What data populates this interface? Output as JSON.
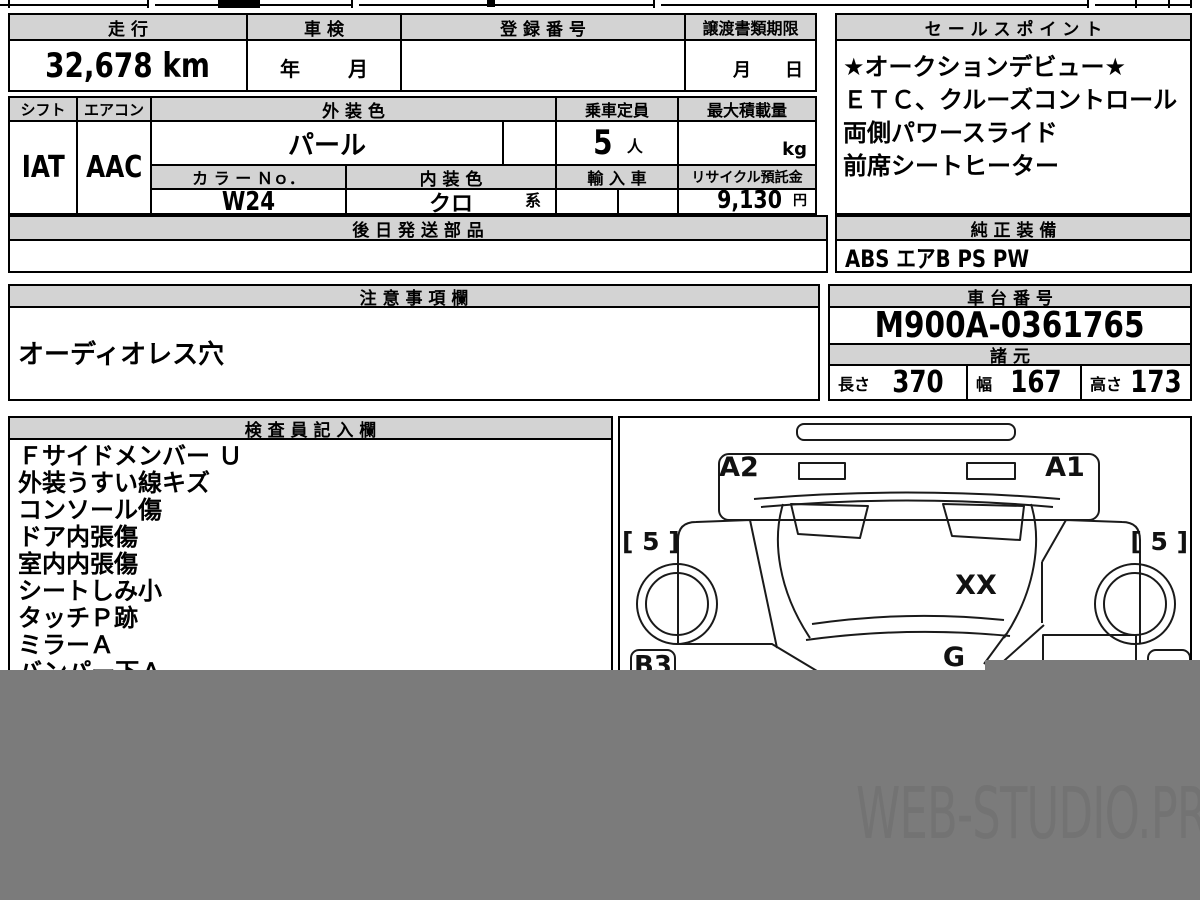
{
  "row1": {
    "mileage": {
      "label": "走 行",
      "value": "32,678 km"
    },
    "shaken": {
      "label": "車 検",
      "year": "年",
      "month": "月"
    },
    "registration": {
      "label": "登 録 番 号",
      "value": ""
    },
    "transfer_deadline": {
      "label": "譲渡書類期限",
      "month": "月",
      "day": "日"
    },
    "sales_points": {
      "label": "セ ー ル ス ポ イ ン ト",
      "lines": [
        "★オークションデビュー★",
        "ＥＴＣ、クルーズコントロール",
        "両側パワースライド",
        "前席シートヒーター"
      ]
    }
  },
  "row2": {
    "shift": {
      "label": "シフト",
      "value": "IAT"
    },
    "aircon": {
      "label": "エアコン",
      "value": "AAC"
    },
    "exterior_color": {
      "label": "外 装 色",
      "value": "パール"
    },
    "color_no": {
      "label": "カ ラ ー Ｎｏ．",
      "value": "W24"
    },
    "interior_color": {
      "label": "内 装 色",
      "value": "クロ",
      "suffix": "系"
    },
    "capacity": {
      "label": "乗車定員",
      "value": "5",
      "unit": "人"
    },
    "max_load": {
      "label": "最大積載量",
      "value": "",
      "unit": "kg"
    },
    "import_car": {
      "label": "輸 入 車",
      "value": ""
    },
    "recycle_deposit": {
      "label": "リサイクル預託金",
      "value": "9,130",
      "unit": "円"
    }
  },
  "later_parts": {
    "label": "後 日 発 送 部 品",
    "value": ""
  },
  "oem_equipment": {
    "label": "純 正 装 備",
    "value": "ABS エアB PS PW"
  },
  "notes": {
    "label": "注 意 事 項 欄",
    "value": "オーディオレス穴"
  },
  "chassis": {
    "label": "車 台 番 号",
    "value": "M900A-0361765"
  },
  "specs": {
    "label": "諸 元",
    "length_label": "長さ",
    "length": "370",
    "width_label": "幅",
    "width": "167",
    "height_label": "高さ",
    "height": "173"
  },
  "inspector": {
    "label": "検 査 員 記 入 欄",
    "items": [
      "Ｆサイドメンバー Ｕ",
      "外装うすい線キズ",
      "コンソール傷",
      "ドア内張傷",
      "室内内張傷",
      "シートしみ小",
      "タッチＰ跡",
      "ミラーＡ",
      "バンパー下Ａ"
    ]
  },
  "diagram": {
    "labels": {
      "a2": "A2",
      "a1": "A1",
      "left5": "[ 5 ]",
      "right5": "[ 5 ]",
      "xx": "XX",
      "g": "G",
      "b3": "B3"
    }
  },
  "watermark": "WEB-STUDIO.PRO",
  "colors": {
    "band": "#7b7b7b",
    "header_fill": "#d3d3d3",
    "border": "#000000"
  }
}
